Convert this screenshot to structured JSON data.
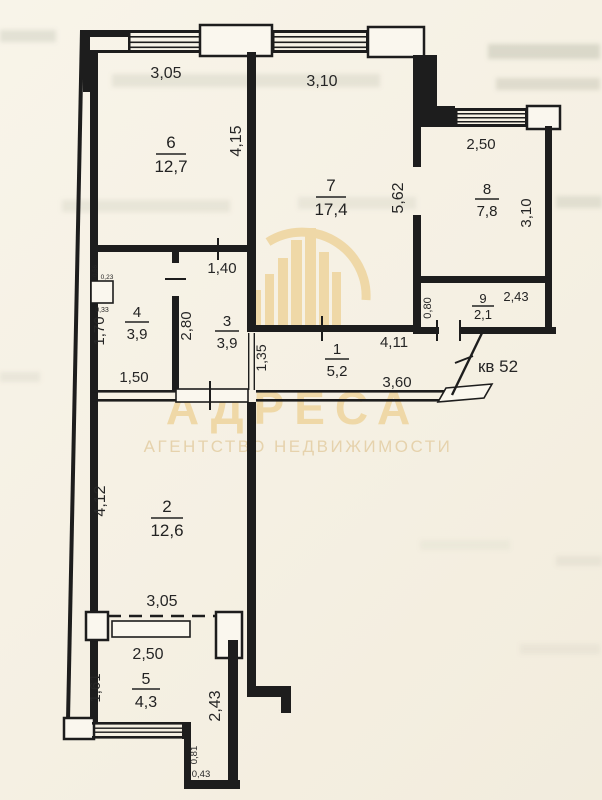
{
  "watermark": {
    "brand": "АДРЕСА",
    "tagline": "АГЕНТСТВО НЕДВИЖИМОСТИ"
  },
  "plan": {
    "apartment_note": "кв 52",
    "rooms": {
      "r1": {
        "num": "1",
        "area": "5,2"
      },
      "r2": {
        "num": "2",
        "area": "12,6"
      },
      "r3": {
        "num": "3",
        "area": "3,9"
      },
      "r4": {
        "num": "4",
        "area": "3,9"
      },
      "r5": {
        "num": "5",
        "area": "4,3"
      },
      "r6": {
        "num": "6",
        "area": "12,7"
      },
      "r7": {
        "num": "7",
        "area": "17,4"
      },
      "r8": {
        "num": "8",
        "area": "7,8"
      },
      "r9": {
        "num": "9",
        "area": "2,1"
      }
    },
    "dims": {
      "win6": "3,05",
      "win7": "3,10",
      "r6_depth": "4,15",
      "r7_depth": "5,62",
      "r8_width": "2,50",
      "r8_depth": "3,10",
      "r9_height": "0,80",
      "r9_width": "2,43",
      "r3_width": "1,40",
      "r3_depth": "2,80",
      "r4_depth": "1,70",
      "r4_width": "1,50",
      "shaft_side": "0,56",
      "shaft_top": "0,23",
      "shaft_bottom": "0,33",
      "hall_width": "4,11",
      "hall_left": "1,35",
      "hall_bottom": "3,60",
      "r2_depth": "4,12",
      "r2_width": "3,05",
      "r5_top": "2,50",
      "r5_left": "1,61",
      "r5_right": "2,43",
      "step_depth": "0,81",
      "step_width": "0,43"
    }
  }
}
